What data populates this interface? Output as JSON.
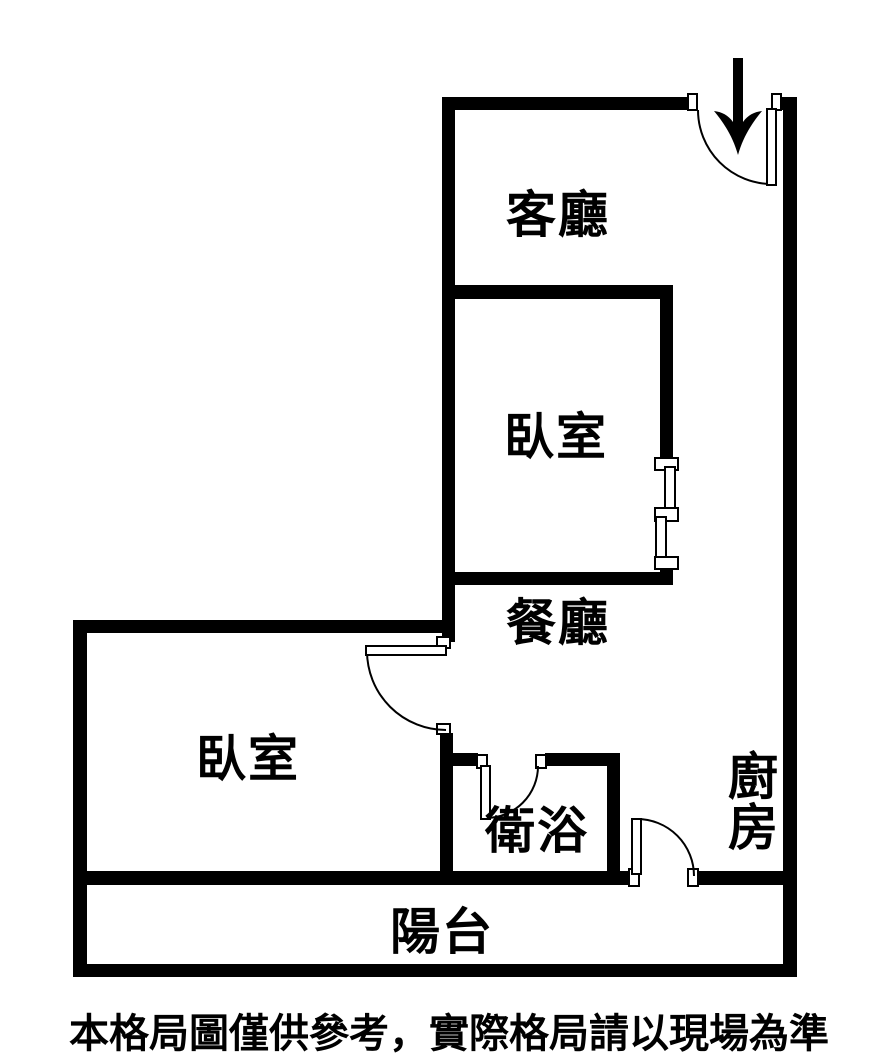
{
  "floorplan": {
    "labels": {
      "living_room": "客廳",
      "bedroom_upper": "臥室",
      "dining_room": "餐廳",
      "bedroom_lower": "臥室",
      "bathroom": "衛浴",
      "kitchen": "廚房",
      "balcony": "陽台"
    },
    "disclaimer": "本格局圖僅供參考，實際格局請以現場為準",
    "icons": {
      "entrance_arrow": "down-arrow-icon"
    },
    "colors": {
      "wall": "#000000",
      "background": "#ffffff",
      "text": "#000000"
    }
  }
}
